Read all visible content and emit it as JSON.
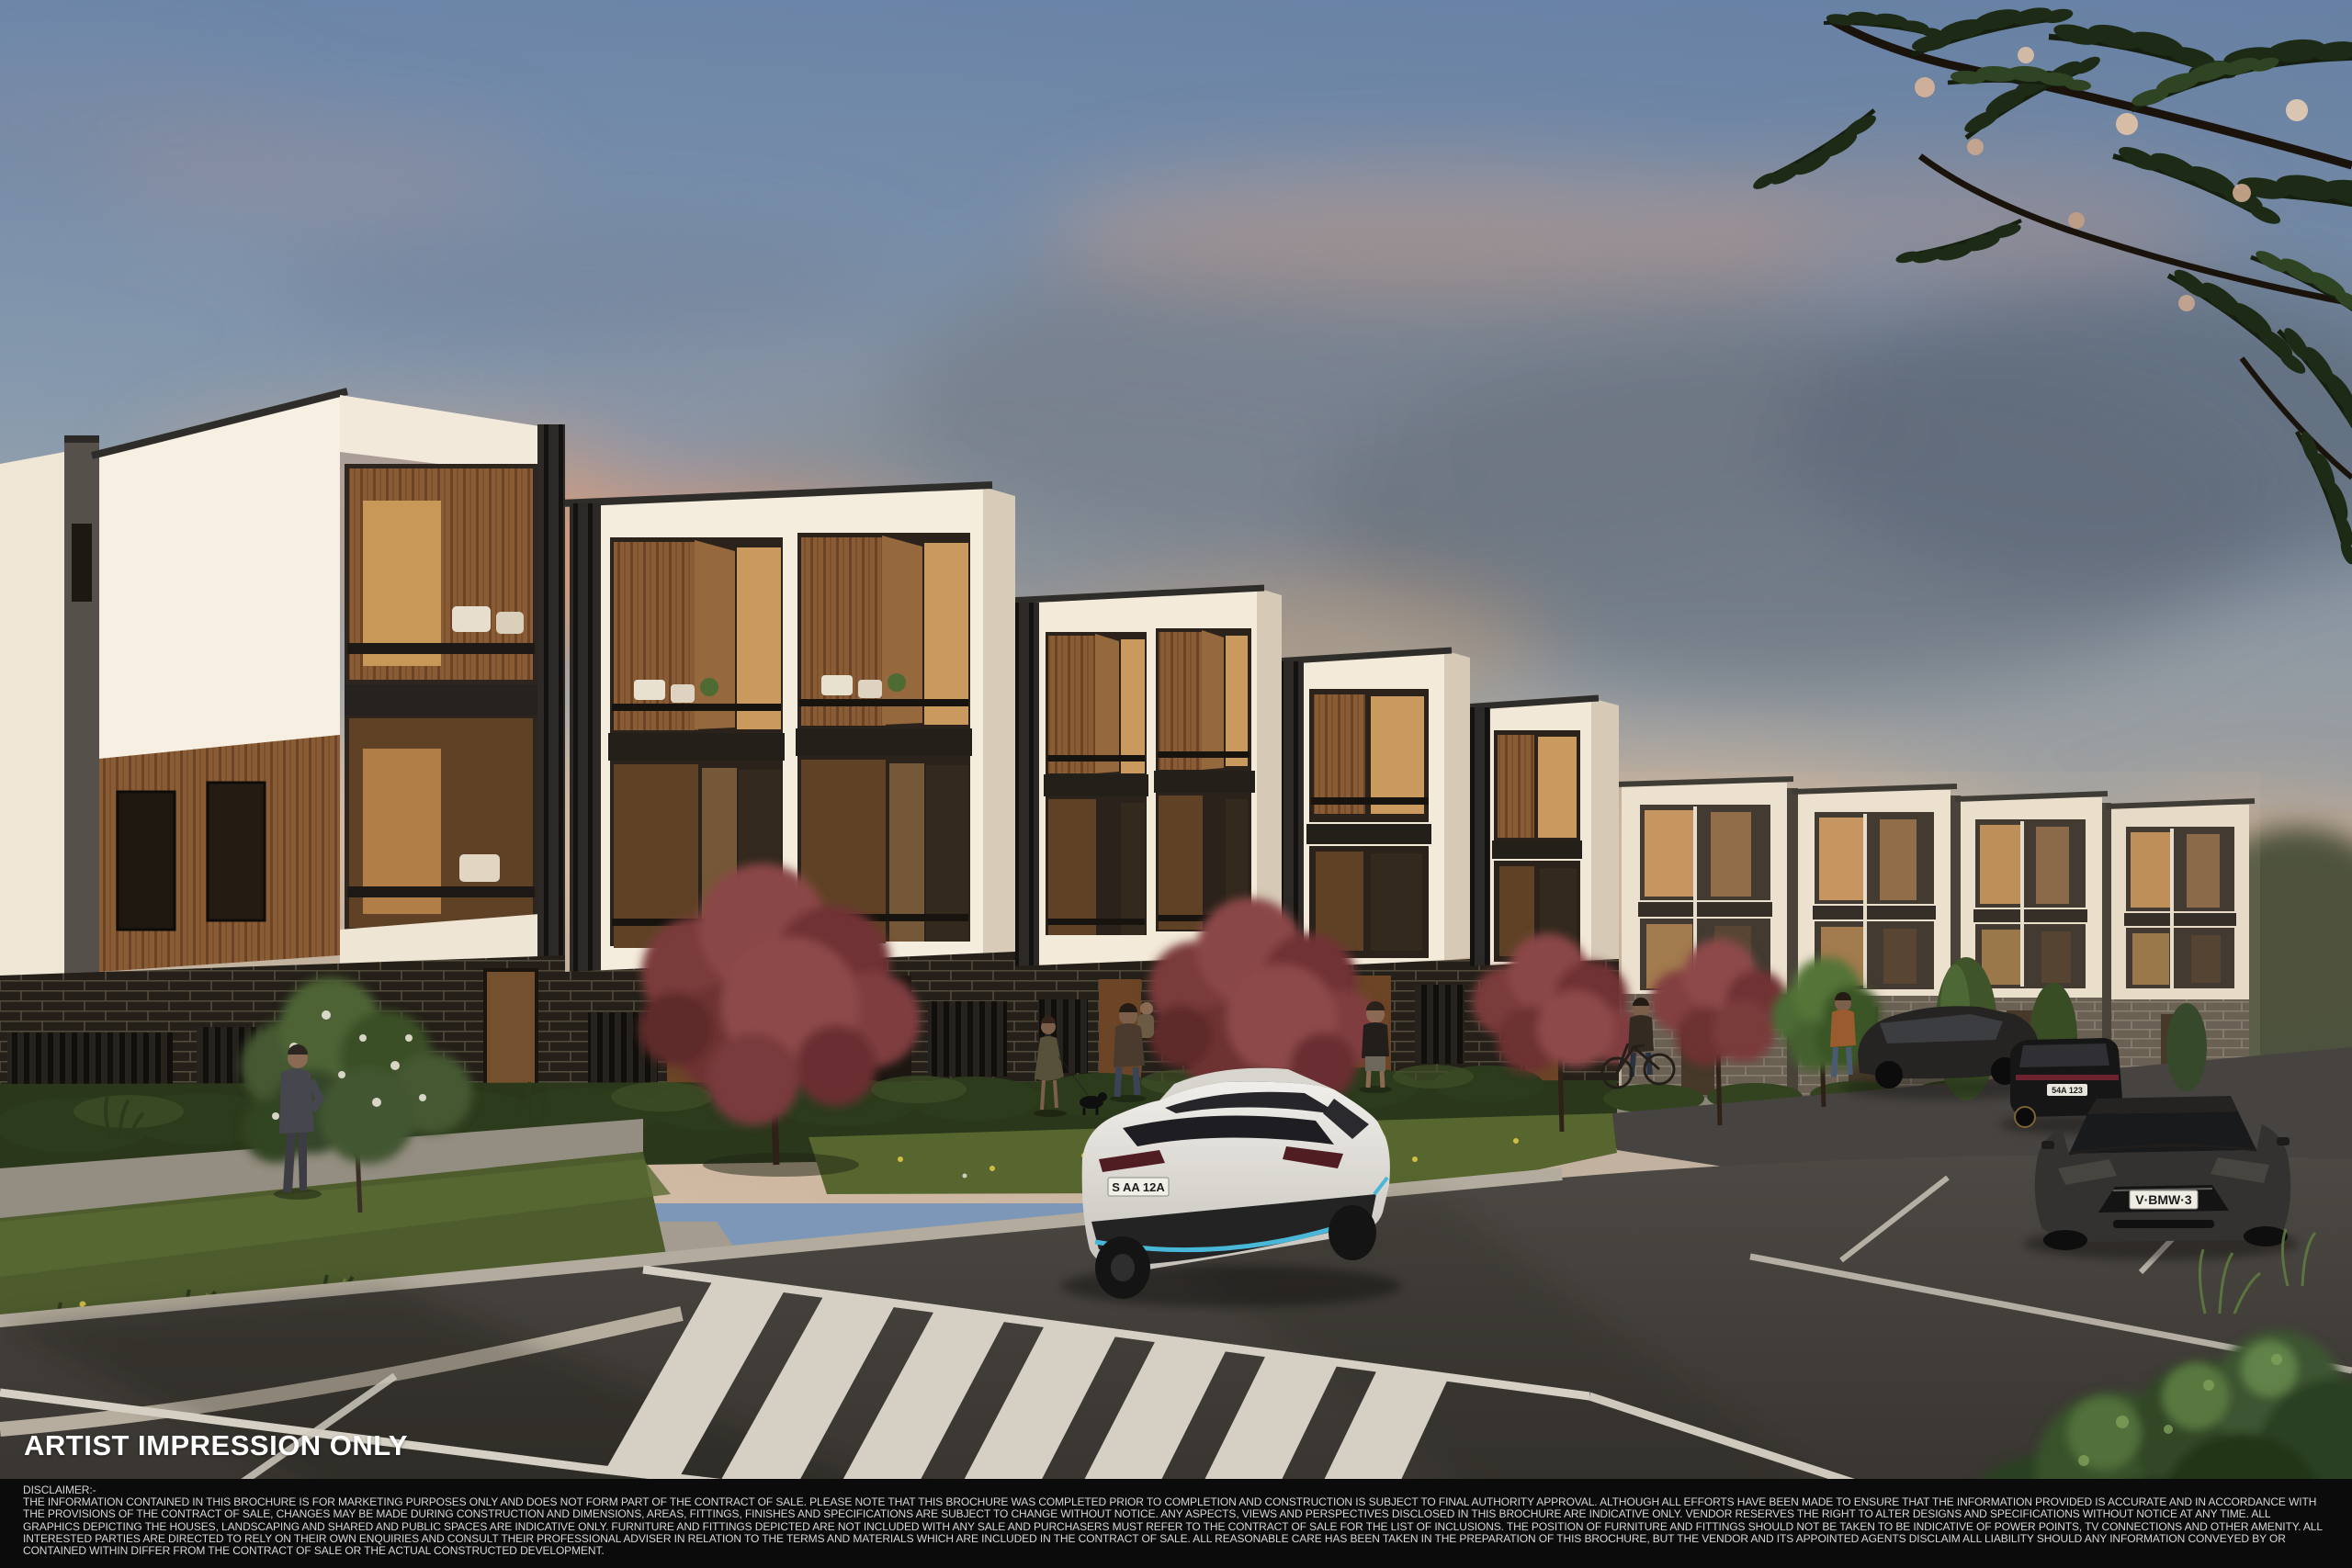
{
  "scene": {
    "description": "Dusk artist impression of a modern three-storey townhouse development: white rendered boxes with recessed timber-lined balconies over a dark brick ground floor, crimson ornamental trees, landscaped verges, a pedestrian crossing, a white hatchback driving away and parked dark cars on the right, under a blue-grey sky with orange-lit clouds and overhanging dark foliage in the top right corner."
  },
  "watermark": {
    "text": "ARTIST IMPRESSION ONLY",
    "color": "#ffffff"
  },
  "disclaimer": {
    "title": "DISCLAIMER:-",
    "body": "THE INFORMATION CONTAINED IN THIS BROCHURE IS FOR MARKETING PURPOSES ONLY AND DOES NOT FORM PART OF THE CONTRACT OF SALE. PLEASE NOTE THAT THIS BROCHURE WAS COMPLETED PRIOR TO COMPLETION AND CONSTRUCTION IS SUBJECT TO FINAL AUTHORITY APPROVAL. ALTHOUGH ALL EFFORTS HAVE BEEN MADE TO ENSURE THAT THE INFORMATION PROVIDED IS ACCURATE AND IN ACCORDANCE WITH THE PROVISIONS OF THE CONTRACT OF SALE, CHANGES MAY BE MADE DURING CONSTRUCTION AND DIMENSIONS, AREAS, FITTINGS, FINISHES AND SPECIFICATIONS ARE SUBJECT TO CHANGE WITHOUT NOTICE. ANY ASPECTS, VIEWS AND PERSPECTIVES DISCLOSED IN THIS BROCHURE ARE INDICATIVE ONLY. VENDOR RESERVES THE RIGHT TO ALTER DESIGNS AND SPECIFICATIONS WITHOUT NOTICE AT ANY TIME. ALL GRAPHICS DEPICTING THE HOUSES, LANDSCAPING AND SHARED AND PUBLIC SPACES ARE INDICATIVE ONLY. FURNITURE AND FITTINGS DEPICTED ARE NOT INCLUDED WITH ANY SALE AND PURCHASERS MUST REFER TO THE CONTRACT OF SALE FOR THE LIST OF INCLUSIONS. THE POSITION OF FURNITURE AND FITTINGS SHOULD NOT BE TAKEN TO BE INDICATIVE OF POWER POINTS, TV CONNECTIONS AND OTHER AMENITY. ALL INTERESTED PARTIES ARE DIRECTED TO RELY ON THEIR OWN ENQUIRIES AND CONSULT THEIR PROFESSIONAL ADVISER IN RELATION TO THE TERMS AND MATERIALS WHICH ARE INCLUDED IN THE CONTRACT OF SALE. ALL REASONABLE CARE HAS BEEN TAKEN IN THE PREPARATION OF THIS BROCHURE, BUT THE VENDOR AND ITS APPOINTED AGENTS DISCLAIM ALL LIABILITY SHOULD ANY INFORMATION CONVEYED BY OR CONTAINED WITHIN DIFFER FROM THE CONTRACT OF SALE OR THE ACTUAL CONSTRUCTED DEVELOPMENT."
  },
  "vehicles": {
    "white_hatchback_plate": "S AA 12A",
    "grey_sedan_plate": "V·BMW·3",
    "black_hatchback_plate": "54A 123"
  },
  "palette": {
    "sky_top": "#6d87aa",
    "sky_warm": "#d9bfa4",
    "cloud_orange": "#e59a68",
    "building_white": "#f4ecdd",
    "timber": "#8a5c36",
    "brick_dark": "#242019",
    "brick_grey": "#5e564b",
    "road": "#45413d",
    "marking": "#d6d0c4",
    "grass": "#4e5c2d",
    "tree_red": "#7d3c3d",
    "car_accent_blue": "#49b8d8"
  }
}
